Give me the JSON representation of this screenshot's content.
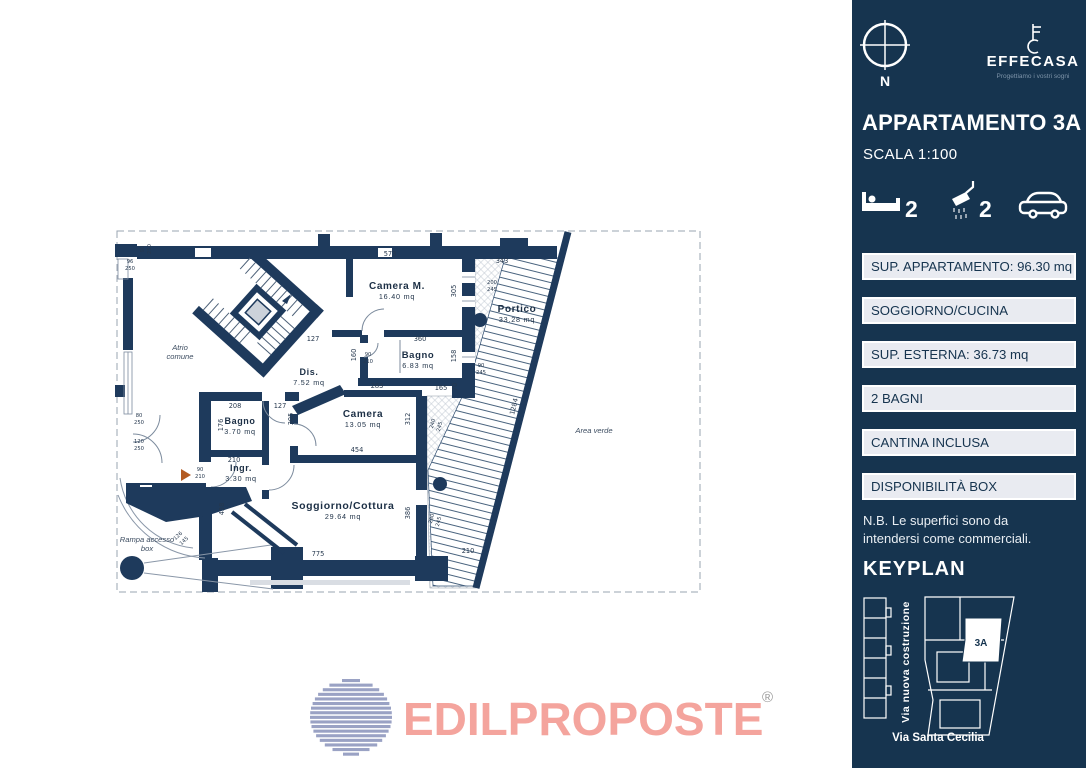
{
  "colors": {
    "sidebar_bg": "#16344f",
    "wall": "#1e3a5c",
    "logo_pink": "#f4a49d",
    "globe_blue": "#9aa2c4",
    "box_bg": "#e9ebf1"
  },
  "sidebar": {
    "compass_label": "N",
    "brand": {
      "name": "EFFECASA",
      "tagline": "Progettiamo i vostri sogni"
    },
    "title": "APPARTAMENTO 3A",
    "scale": "SCALA 1:100",
    "stats": {
      "beds": "2",
      "baths": "2"
    },
    "info_boxes": [
      "SUP. APPARTAMENTO: 96.30 mq",
      "SOGGIORNO/CUCINA",
      "SUP. ESTERNA:  36.73 mq",
      "2 BAGNI",
      "CANTINA INCLUSA",
      "DISPONIBILITÀ BOX"
    ],
    "note_line1": "N.B. Le superfici sono da",
    "note_line2": "intendersi come commerciali.",
    "keyplan_title": "KEYPLAN",
    "keyplan": {
      "unit_label": "3A",
      "street_vertical": "Via nuova costruzione",
      "street_bottom": "Via Santa Cecilia"
    }
  },
  "footer_logo": {
    "text": "EDILPROPOSTE",
    "registered": "®"
  },
  "floorplan": {
    "rooms": [
      {
        "label": "Camera  M.",
        "sub": "16.40  mq",
        "x": 397,
        "y": 289,
        "fs": 10
      },
      {
        "label": "Bagno",
        "sub": "6.83  mq",
        "x": 418,
        "y": 358,
        "fs": 9.5
      },
      {
        "label": "Dis.",
        "sub": "7.52  mq",
        "x": 309,
        "y": 375,
        "fs": 9
      },
      {
        "label": "Camera",
        "sub": "13.05  mq",
        "x": 363,
        "y": 417,
        "fs": 10
      },
      {
        "label": "Bagno",
        "sub": "3.70  mq",
        "x": 240,
        "y": 424,
        "fs": 9
      },
      {
        "label": "Ingr.",
        "sub": "3.30  mq",
        "x": 241,
        "y": 471,
        "fs": 9
      },
      {
        "label": "Soggiorno/Cottura",
        "sub": "29.64  mq",
        "x": 343,
        "y": 509,
        "fs": 10.5
      },
      {
        "label": "Portico",
        "sub": "33.28  mq",
        "x": 517,
        "y": 312,
        "fs": 10
      }
    ],
    "labels": [
      {
        "lines": [
          "Atrio",
          "comune"
        ],
        "x": 180,
        "y": 350
      },
      {
        "lines": [
          "Area verde"
        ],
        "x": 594,
        "y": 433
      },
      {
        "lines": [
          "Rampa accesso",
          "box"
        ],
        "x": 147,
        "y": 542
      }
    ],
    "dimensions": [
      {
        "t": "573",
        "x": 390,
        "y": 256,
        "r": 0
      },
      {
        "t": "343",
        "x": 502,
        "y": 263,
        "r": 0
      },
      {
        "t": "305",
        "x": 456,
        "y": 291,
        "r": -90
      },
      {
        "t": "200",
        "x": 492,
        "y": 284,
        "r": 0,
        "s": true
      },
      {
        "t": "245",
        "x": 492,
        "y": 291,
        "r": 0,
        "s": true
      },
      {
        "t": "360",
        "x": 420,
        "y": 341,
        "r": 0
      },
      {
        "t": "127",
        "x": 313,
        "y": 341,
        "r": 0
      },
      {
        "t": "160",
        "x": 356,
        "y": 355,
        "r": -90
      },
      {
        "t": "158",
        "x": 456,
        "y": 356,
        "r": -90
      },
      {
        "t": "90",
        "x": 368,
        "y": 356,
        "r": 0,
        "s": true
      },
      {
        "t": "210",
        "x": 368,
        "y": 363,
        "r": 0,
        "s": true
      },
      {
        "t": "90",
        "x": 481,
        "y": 367,
        "r": 0,
        "s": true
      },
      {
        "t": "245",
        "x": 481,
        "y": 374,
        "r": 0,
        "s": true
      },
      {
        "t": "165",
        "x": 441,
        "y": 390,
        "r": 0
      },
      {
        "t": "70",
        "x": 457,
        "y": 387,
        "r": -90
      },
      {
        "t": "283",
        "x": 377,
        "y": 388,
        "r": 0
      },
      {
        "t": "312",
        "x": 410,
        "y": 419,
        "r": -90
      },
      {
        "t": "454",
        "x": 357,
        "y": 452,
        "r": 0
      },
      {
        "t": "240",
        "x": 434,
        "y": 424,
        "r": -75,
        "s": true
      },
      {
        "t": "245",
        "x": 441,
        "y": 427,
        "r": -75,
        "s": true
      },
      {
        "t": "208",
        "x": 235,
        "y": 408,
        "r": 0
      },
      {
        "t": "127",
        "x": 280,
        "y": 408,
        "r": 0
      },
      {
        "t": "176",
        "x": 223,
        "y": 425,
        "r": -90
      },
      {
        "t": "305",
        "x": 293,
        "y": 419,
        "r": -90
      },
      {
        "t": "210",
        "x": 234,
        "y": 462,
        "r": 0
      },
      {
        "t": "90",
        "x": 200,
        "y": 471,
        "r": 0,
        "s": true
      },
      {
        "t": "210",
        "x": 200,
        "y": 478,
        "r": 0,
        "s": true
      },
      {
        "t": "438",
        "x": 224,
        "y": 509,
        "r": -90
      },
      {
        "t": "775",
        "x": 318,
        "y": 556,
        "r": 0
      },
      {
        "t": "386",
        "x": 410,
        "y": 513,
        "r": -90
      },
      {
        "t": "280",
        "x": 433,
        "y": 519,
        "r": -75,
        "s": true
      },
      {
        "t": "245",
        "x": 440,
        "y": 522,
        "r": -75,
        "s": true
      },
      {
        "t": "210",
        "x": 468,
        "y": 553,
        "r": 0
      },
      {
        "t": "1284",
        "x": 516,
        "y": 407,
        "r": -76
      },
      {
        "t": "96",
        "x": 130,
        "y": 263,
        "r": 0,
        "s": true
      },
      {
        "t": "250",
        "x": 130,
        "y": 270,
        "r": 0,
        "s": true
      },
      {
        "t": "90",
        "x": 144,
        "y": 249,
        "r": -90,
        "s": true
      },
      {
        "t": "250",
        "x": 151,
        "y": 249,
        "r": -90,
        "s": true
      },
      {
        "t": "80",
        "x": 139,
        "y": 417,
        "r": 0,
        "s": true
      },
      {
        "t": "250",
        "x": 139,
        "y": 424,
        "r": 0,
        "s": true
      },
      {
        "t": "120",
        "x": 139,
        "y": 443,
        "r": 0,
        "s": true
      },
      {
        "t": "250",
        "x": 139,
        "y": 450,
        "r": 0,
        "s": true
      },
      {
        "t": "126",
        "x": 179,
        "y": 537,
        "r": -42,
        "s": true
      },
      {
        "t": "145",
        "x": 185,
        "y": 542,
        "r": -42,
        "s": true
      }
    ]
  }
}
